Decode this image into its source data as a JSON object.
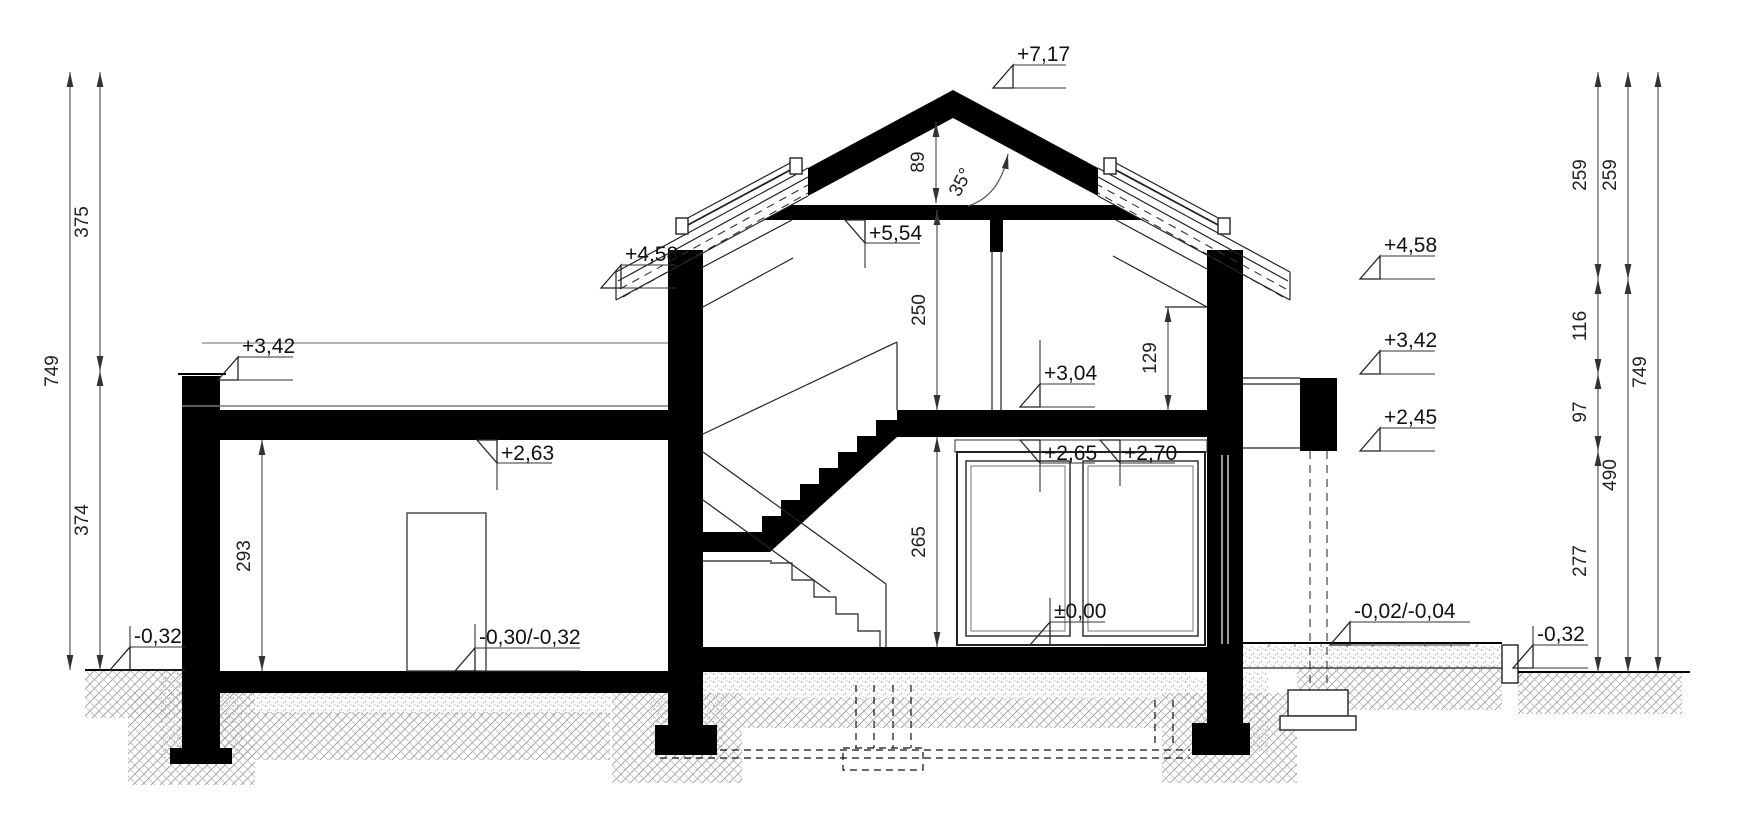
{
  "drawing": {
    "type": "house-cross-section",
    "levels": {
      "ridge": "+7,17",
      "attic_ceiling": "+5,54",
      "eaves_left": "+4,58",
      "eaves_right": "+4,58",
      "parapet_left": "+3,42",
      "parapet_right": "+3,42",
      "attic_floor": "+3,04",
      "ceiling_a": "+2,65",
      "ceiling_b": "+2,70",
      "garage_ceiling": "+2,63",
      "canopy_soffit": "+2,45",
      "ground_floor": "±0,00",
      "terrace": "-0,02/-0,04",
      "garage_floor": "-0,30/-0,32",
      "grade_left": "-0,32",
      "grade_right": "-0,32"
    },
    "dimensions_cm": {
      "left_total": "749",
      "left_upper": "375",
      "left_lower": "374",
      "right_roof_a": "259",
      "right_roof_b": "259",
      "right_knee": "116",
      "right_band": "97",
      "right_ground": "277",
      "right_storey": "490",
      "right_total": "749",
      "attic_height": "250",
      "ridge_height": "89",
      "knee_height": "129",
      "ground_height": "265",
      "garage_height": "293"
    },
    "angles": {
      "roof_pitch": "35°"
    }
  }
}
